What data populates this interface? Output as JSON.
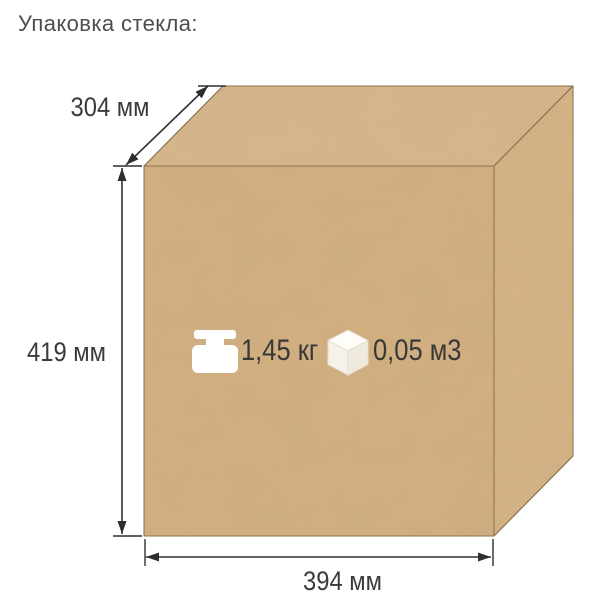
{
  "page": {
    "title": "Упаковка стекла:",
    "background": "#ffffff"
  },
  "diagram": {
    "subject": "cardboard-box",
    "dimensions": {
      "depth": "304 мм",
      "height": "419 мм",
      "width": "394 мм"
    },
    "specs": {
      "weight": {
        "icon": "weight-icon",
        "value": "1,45 кг"
      },
      "volume": {
        "icon": "cube-icon",
        "value": "0,05 м3"
      }
    },
    "colors": {
      "cardboard_front": "#d3b082",
      "cardboard_top": "#d8b88c",
      "cardboard_side": "#d6b487",
      "edge": "#8a6f4e",
      "dimension_line": "#2e2e2e",
      "label_text": "#3b3b3b",
      "icon": "#ffffff"
    }
  }
}
